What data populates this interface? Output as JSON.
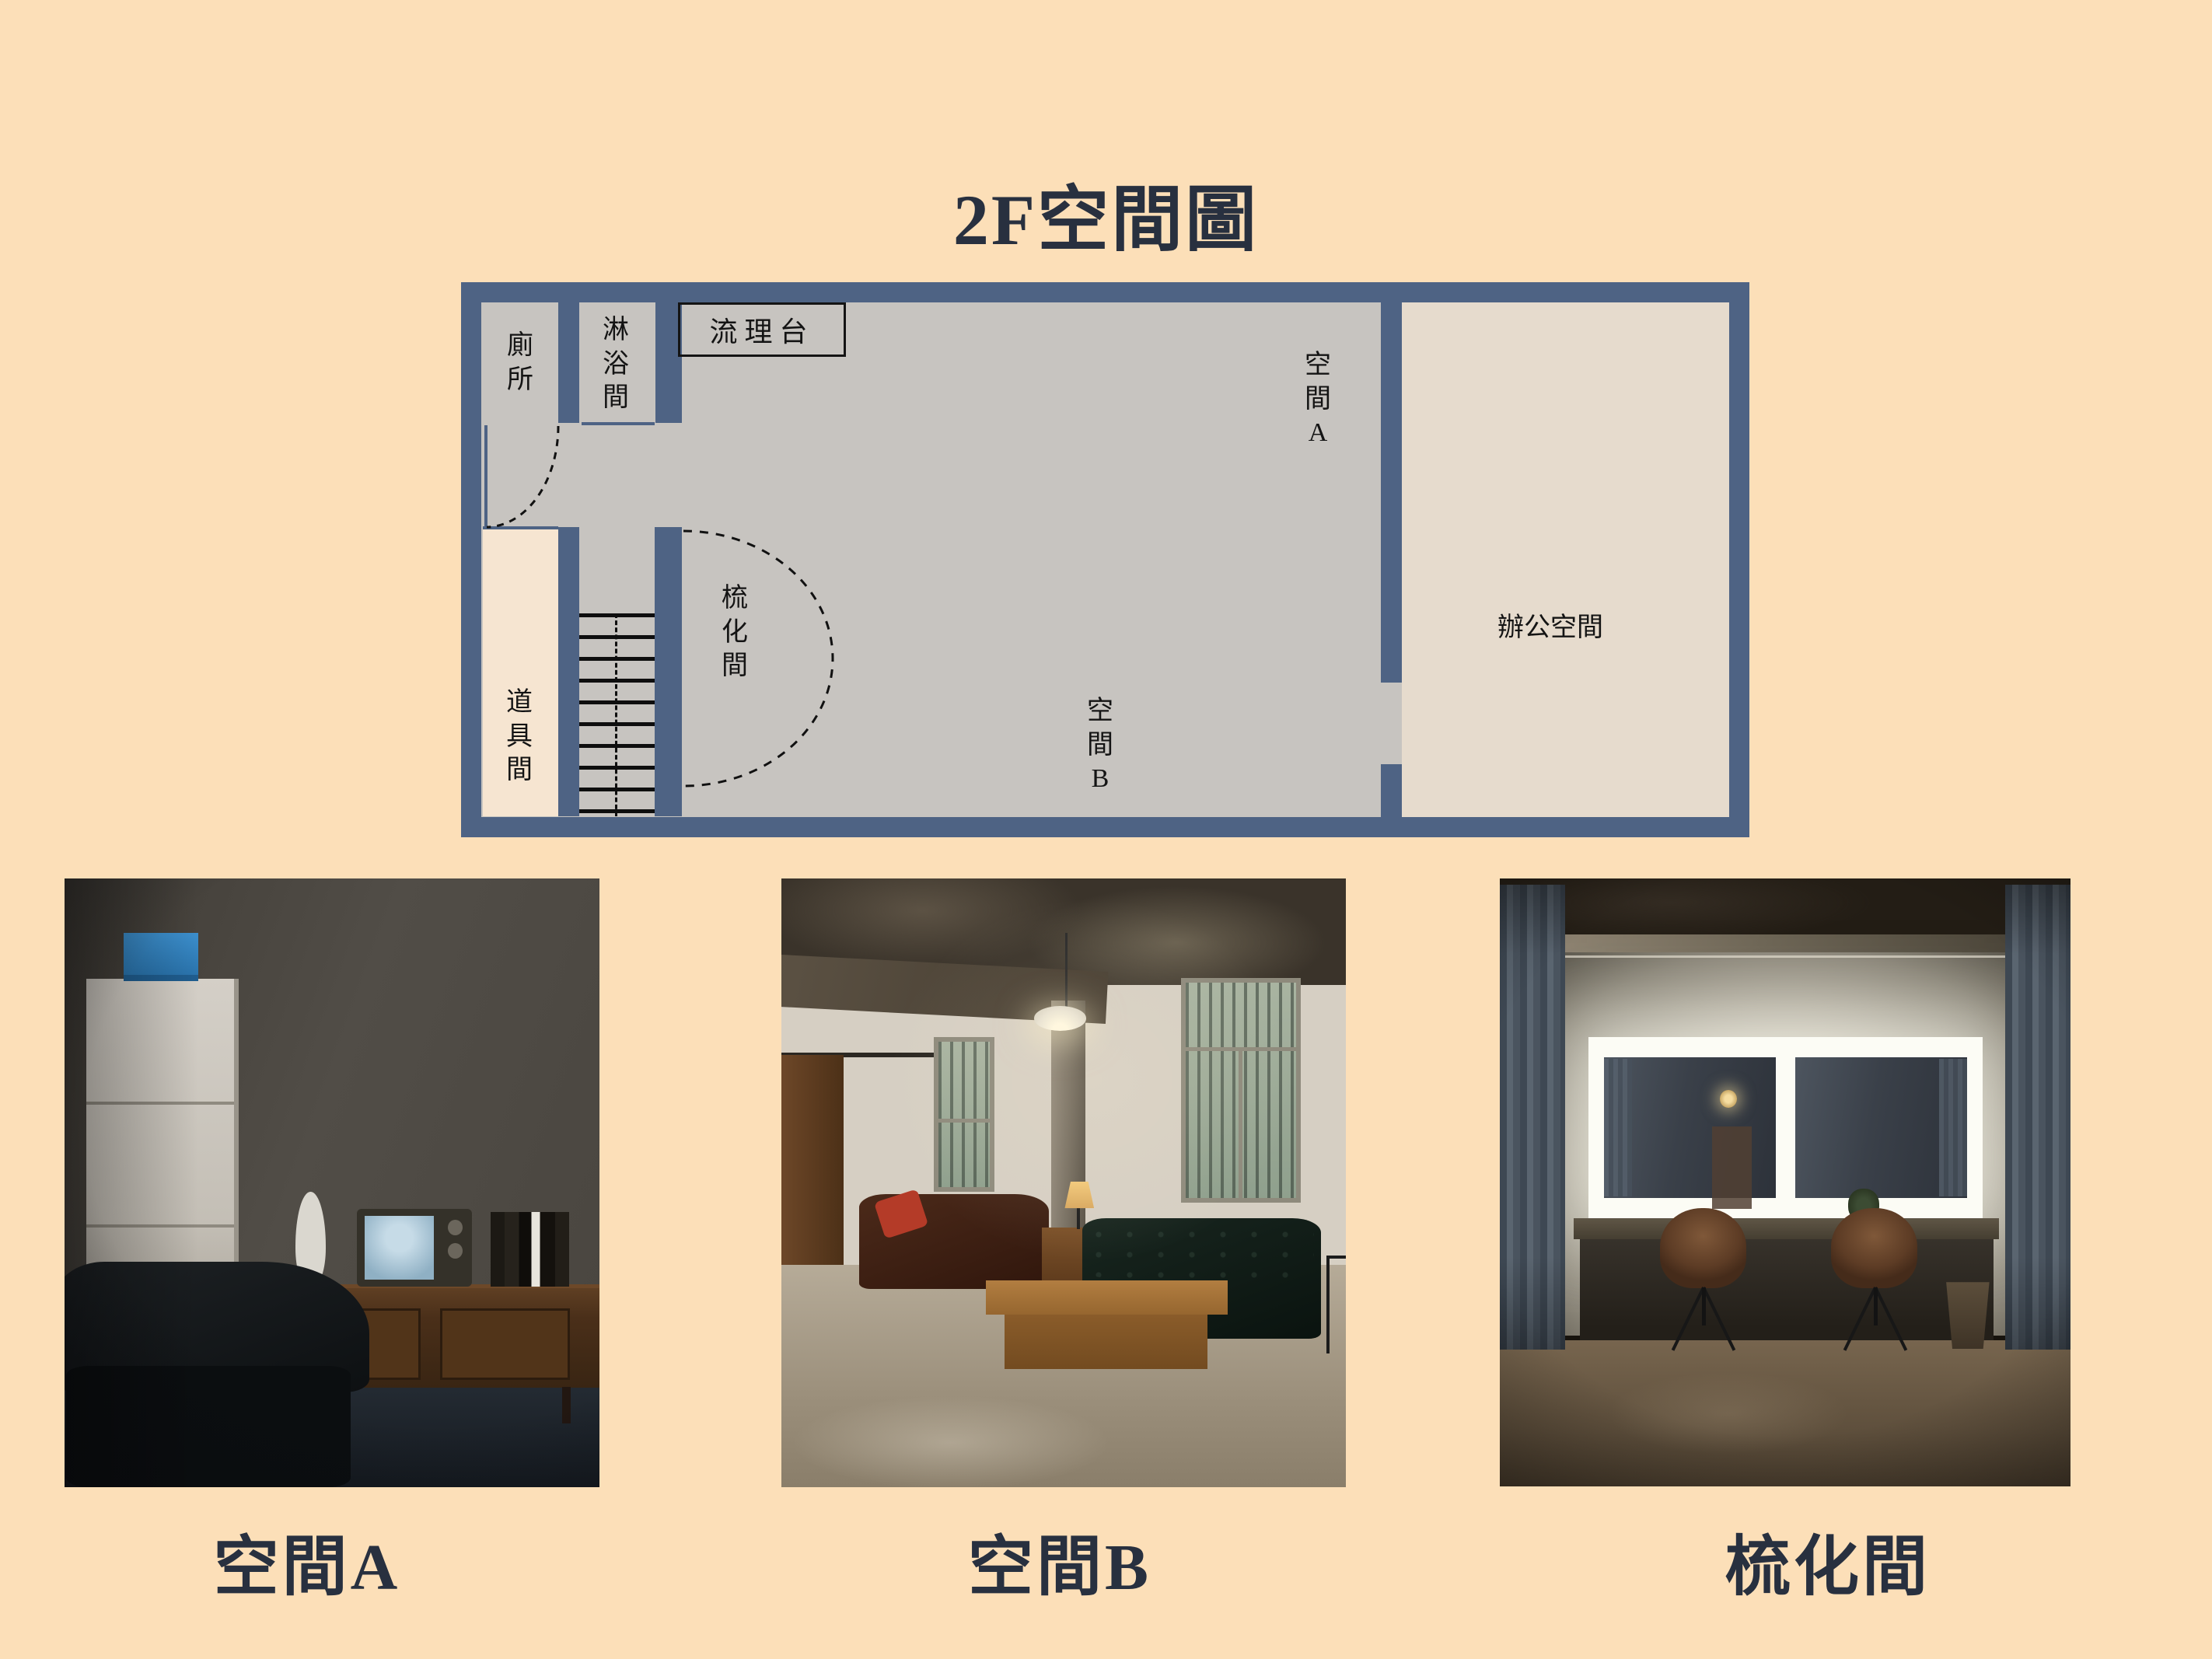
{
  "page": {
    "title": "2F空間圖"
  },
  "colors": {
    "bg": "#FCDFB8",
    "ink": "#28303F",
    "wall": "#4E6384",
    "plan-floor": "#C7C4C0",
    "office-floor": "#E6DBCD",
    "props-floor": "#F6E5D1",
    "label-ink": "#141414"
  },
  "floor_plan": {
    "labels": {
      "toilet": "廁所",
      "shower": "淋浴間",
      "sink_counter": "流理台",
      "space_a": "空間A",
      "space_b": "空間B",
      "makeup_room": "梳化間",
      "props_room": "道具間",
      "office": "辦公空間"
    }
  },
  "photos": [
    {
      "caption": "空間A"
    },
    {
      "caption": "空間B"
    },
    {
      "caption": "梳化間"
    }
  ]
}
